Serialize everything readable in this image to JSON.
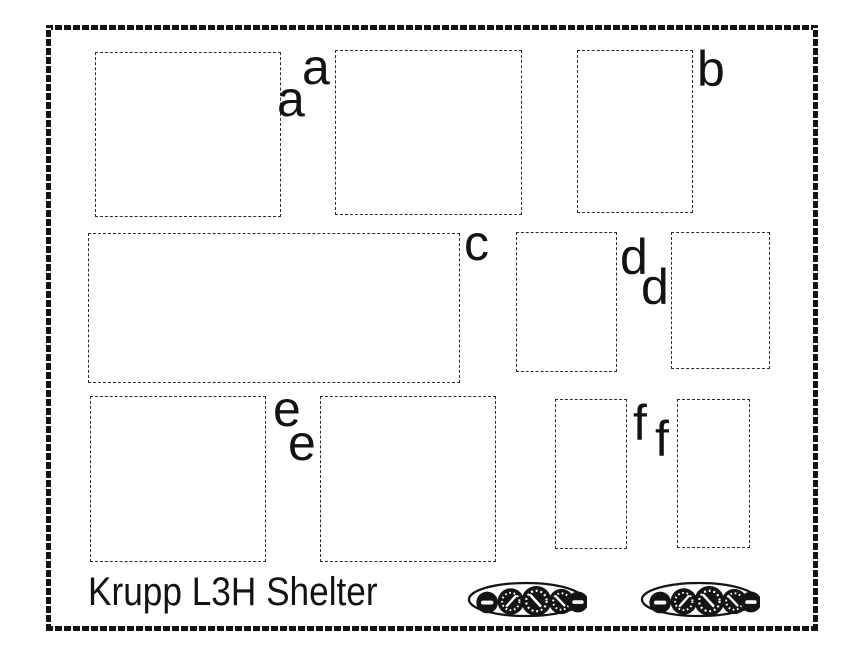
{
  "sheet": {
    "title": "Krupp L3H Shelter"
  },
  "labels": {
    "a1": "a",
    "a2": "a",
    "b": "b",
    "c": "c",
    "d1": "d",
    "d2": "d",
    "e1": "e",
    "e2": "e",
    "f1": "f",
    "f2": "f"
  },
  "panels": {
    "count": 2,
    "name": "instrument-panel-decal",
    "instrument_layout": [
      "knob",
      "gauge",
      "gauge",
      "gauge",
      "knob"
    ]
  },
  "colors": {
    "ink": "#131313",
    "paper": "#ffffff"
  }
}
